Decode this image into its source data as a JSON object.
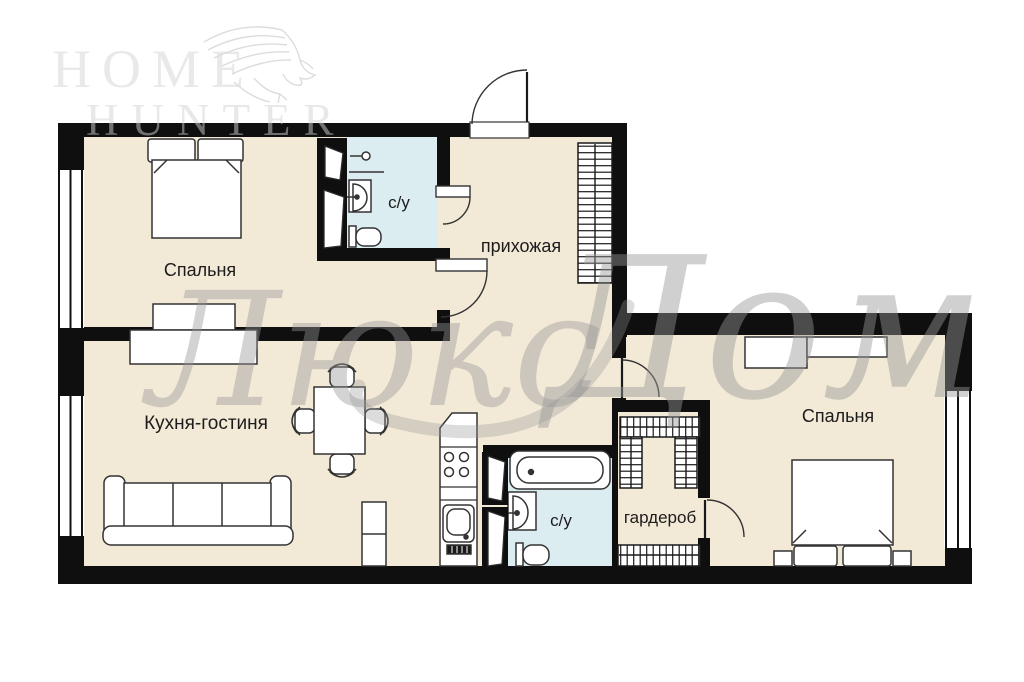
{
  "watermark": {
    "logo_top": "HOME",
    "logo_bottom": "HUNTER",
    "script_left": "Люкс",
    "script_right": "Дом"
  },
  "rooms": {
    "bedroom_left": "Спальня",
    "bedroom_right": "Спальня",
    "kitchen_living": "Кухня-гостиня",
    "hallway": "прихожая",
    "wardrobe": "гардероб",
    "bathroom_top": "с/у",
    "bathroom_bottom": "с/у"
  },
  "colors": {
    "wall": "#0f0f0f",
    "floor": "#f3e9d7",
    "wet_floor": "#dcedf1",
    "furniture_stroke": "#333333",
    "label": "#1c1c1c",
    "watermark_script": "#969696",
    "watermark_logo": "#d7d7d7"
  }
}
